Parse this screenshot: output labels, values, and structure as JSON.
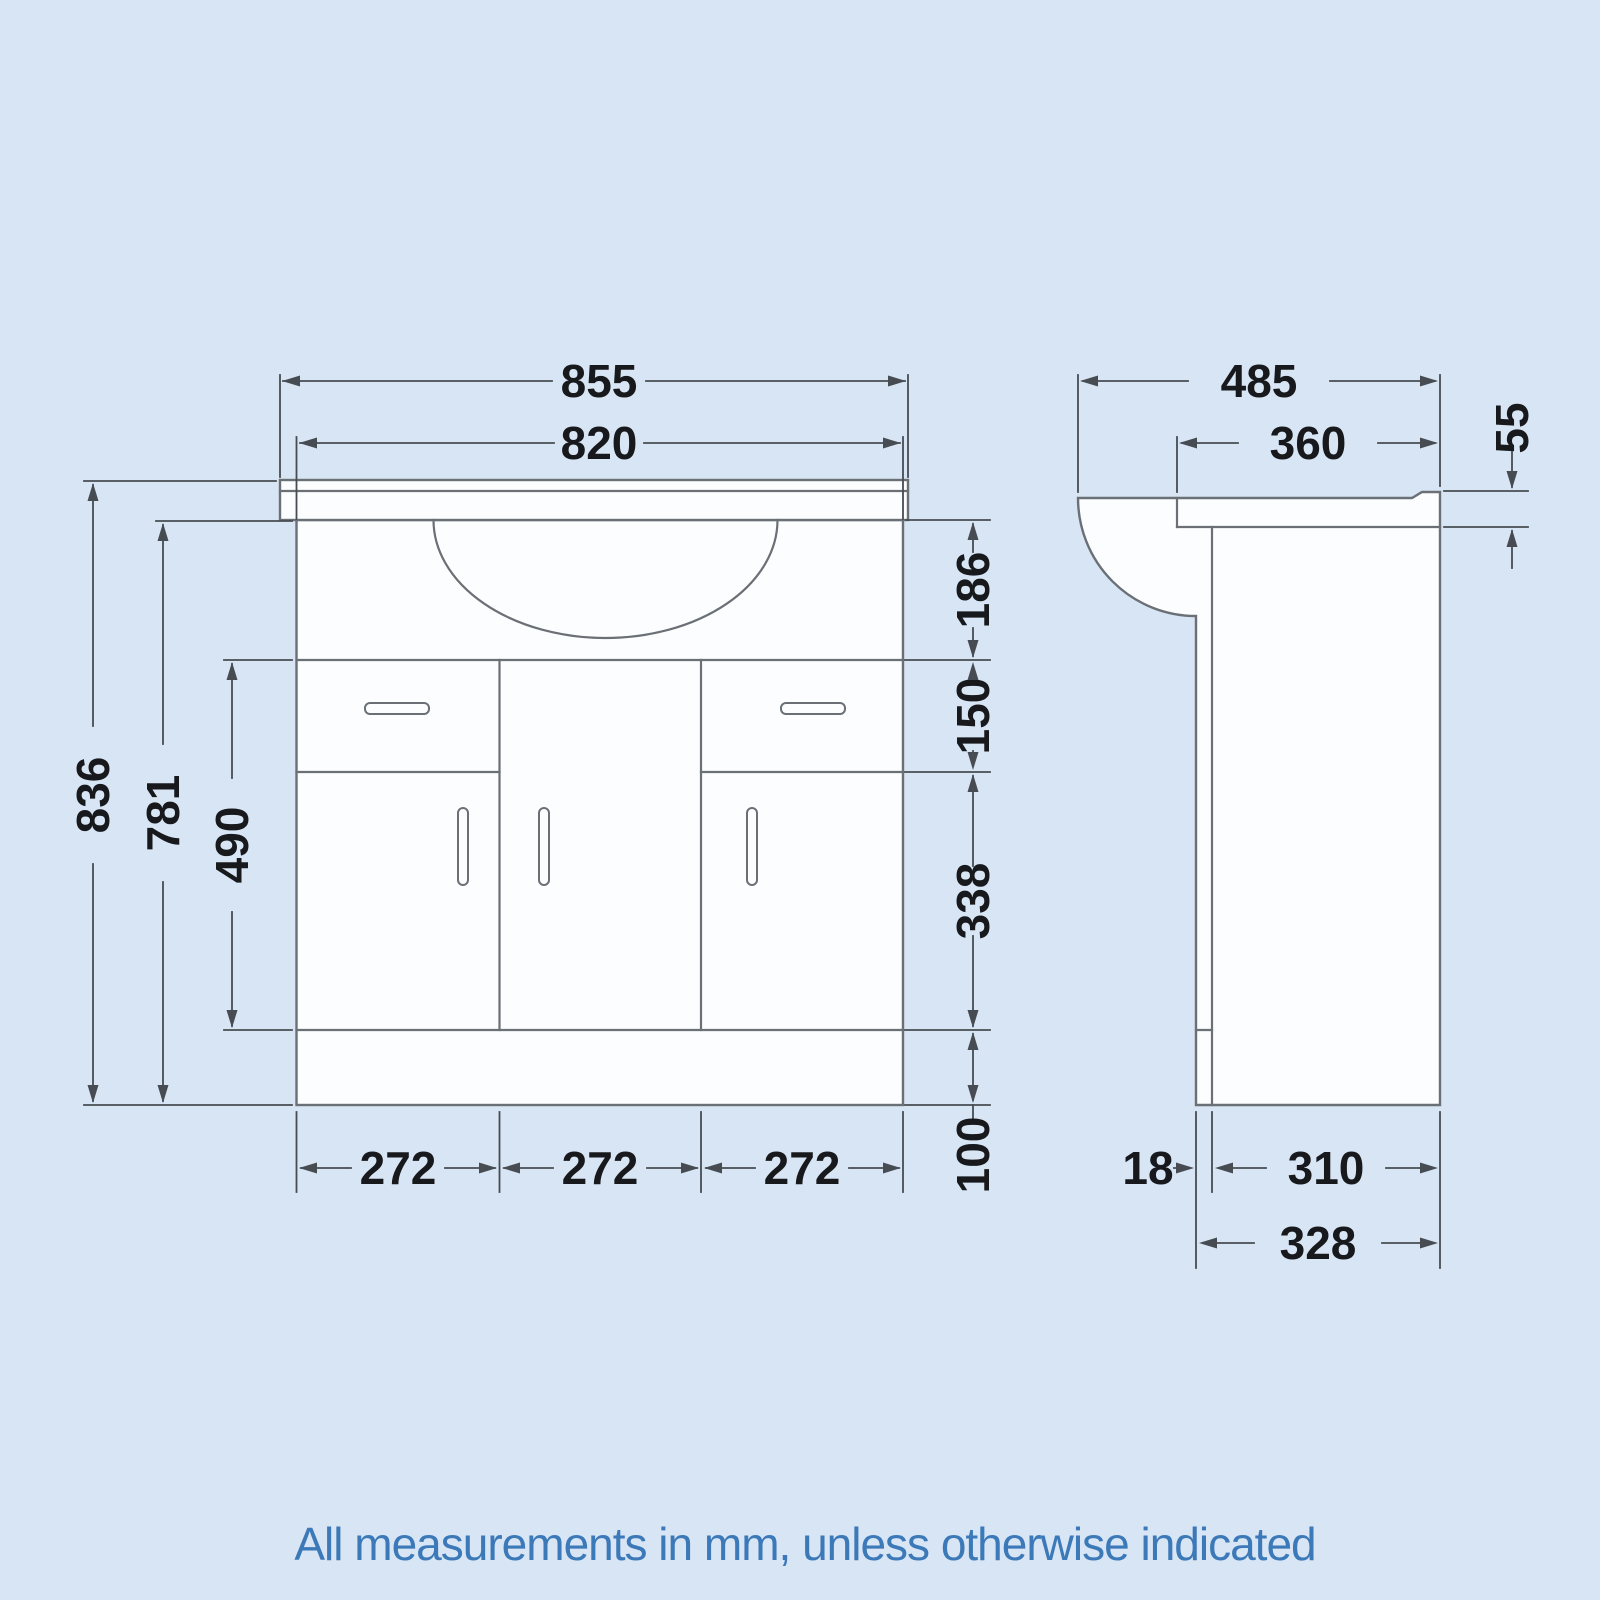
{
  "caption": {
    "text": "All measurements in mm, unless otherwise indicated"
  },
  "colors": {
    "background": "#d8e5f4",
    "drawing_line": "#6a7076",
    "dimension_line": "#464c52",
    "dimension_text": "#17191c",
    "caption_text": "#3c79b8"
  },
  "front_view": {
    "name": "vanity-unit-front-elevation",
    "dims": {
      "counter_width": "855",
      "basin_width": "820",
      "overall_height": "836",
      "cabinet_height": "781",
      "doors_drawers_height": "490",
      "apron_height": "186",
      "drawer_height": "150",
      "door_height": "338",
      "plinth_height": "100",
      "bay_width_1": "272",
      "bay_width_2": "272",
      "bay_width_3": "272"
    }
  },
  "side_view": {
    "name": "vanity-unit-side-elevation",
    "dims": {
      "overall_depth": "485",
      "worktop_depth": "360",
      "worktop_thickness": "55",
      "door_thickness": "18",
      "carcass_depth": "310",
      "base_depth": "328"
    }
  }
}
